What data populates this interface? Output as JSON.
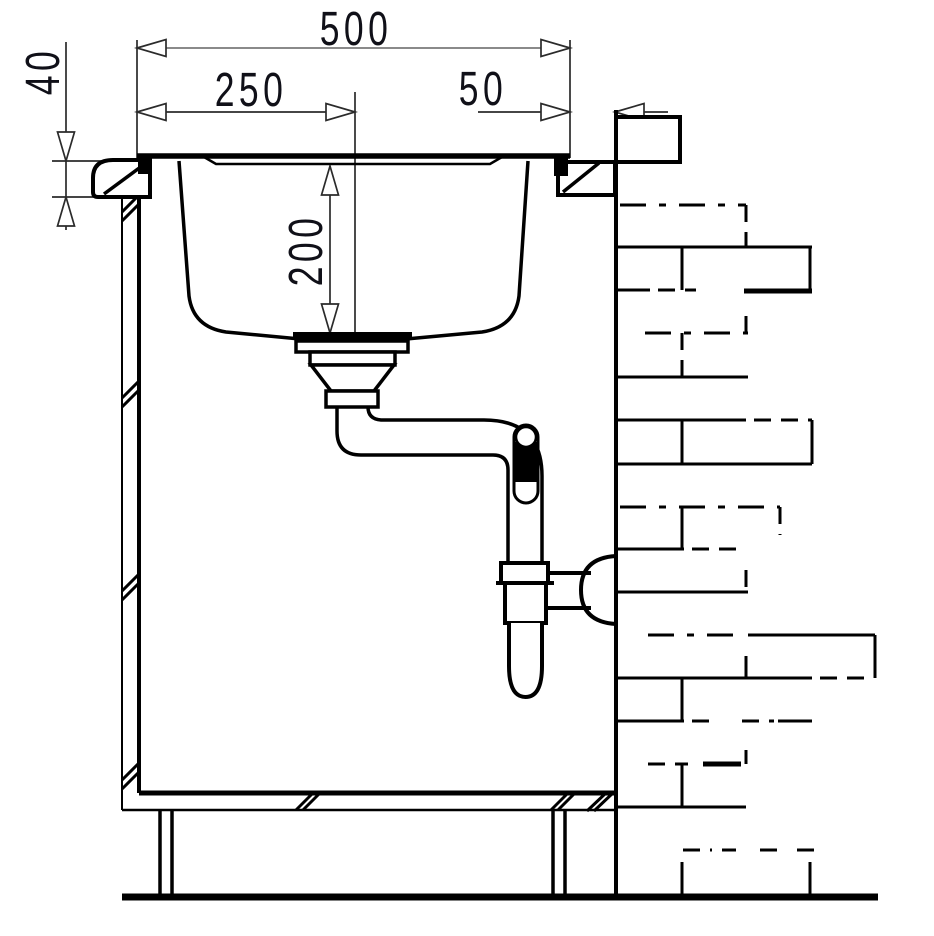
{
  "drawing": {
    "type": "technical-section",
    "subject": "kitchen sink installation cross-section with waste trap and wall",
    "background_color": "#ffffff",
    "line_color": "#000000",
    "dimension_line_color": "#7a7a7a",
    "extension_line_color": "#2b2b2b",
    "text_color": "#101018",
    "dimensions": {
      "total_width": "500",
      "drain_center_offset": "250",
      "edge_to_wall_gap": "50",
      "countertop_thickness": "40",
      "bowl_depth": "200"
    }
  }
}
